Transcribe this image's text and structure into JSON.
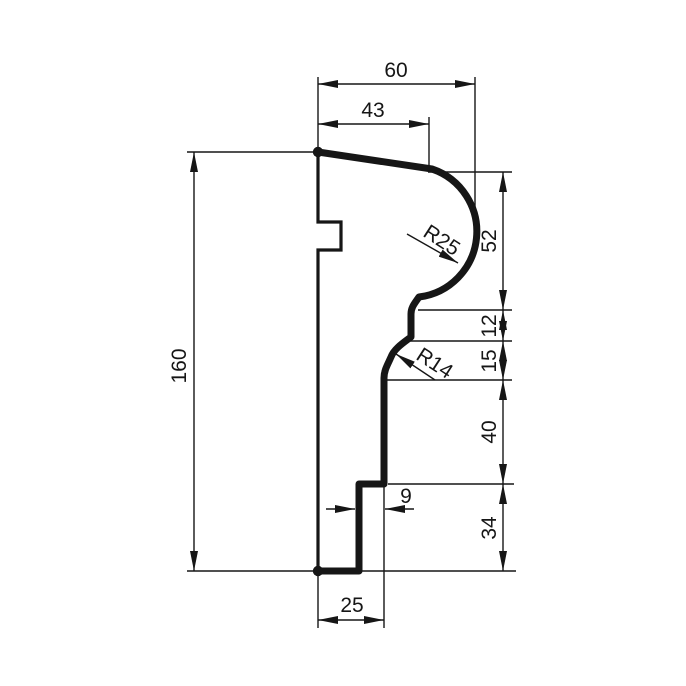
{
  "drawing": {
    "title": "moulding-profile-cross-section",
    "units": "mm",
    "colors": {
      "line": "#161616",
      "background": "#ffffff"
    },
    "dims": {
      "overall_width": "60",
      "top_face_width": "43",
      "overall_height": "160",
      "crown_height": "52",
      "fillet_height": "12",
      "cove_height": "15",
      "web_height": "40",
      "base_height": "34",
      "base_width": "25",
      "step_depth": "9"
    },
    "radii": {
      "crown_radius": "R25",
      "cove_radius": "R14"
    }
  }
}
